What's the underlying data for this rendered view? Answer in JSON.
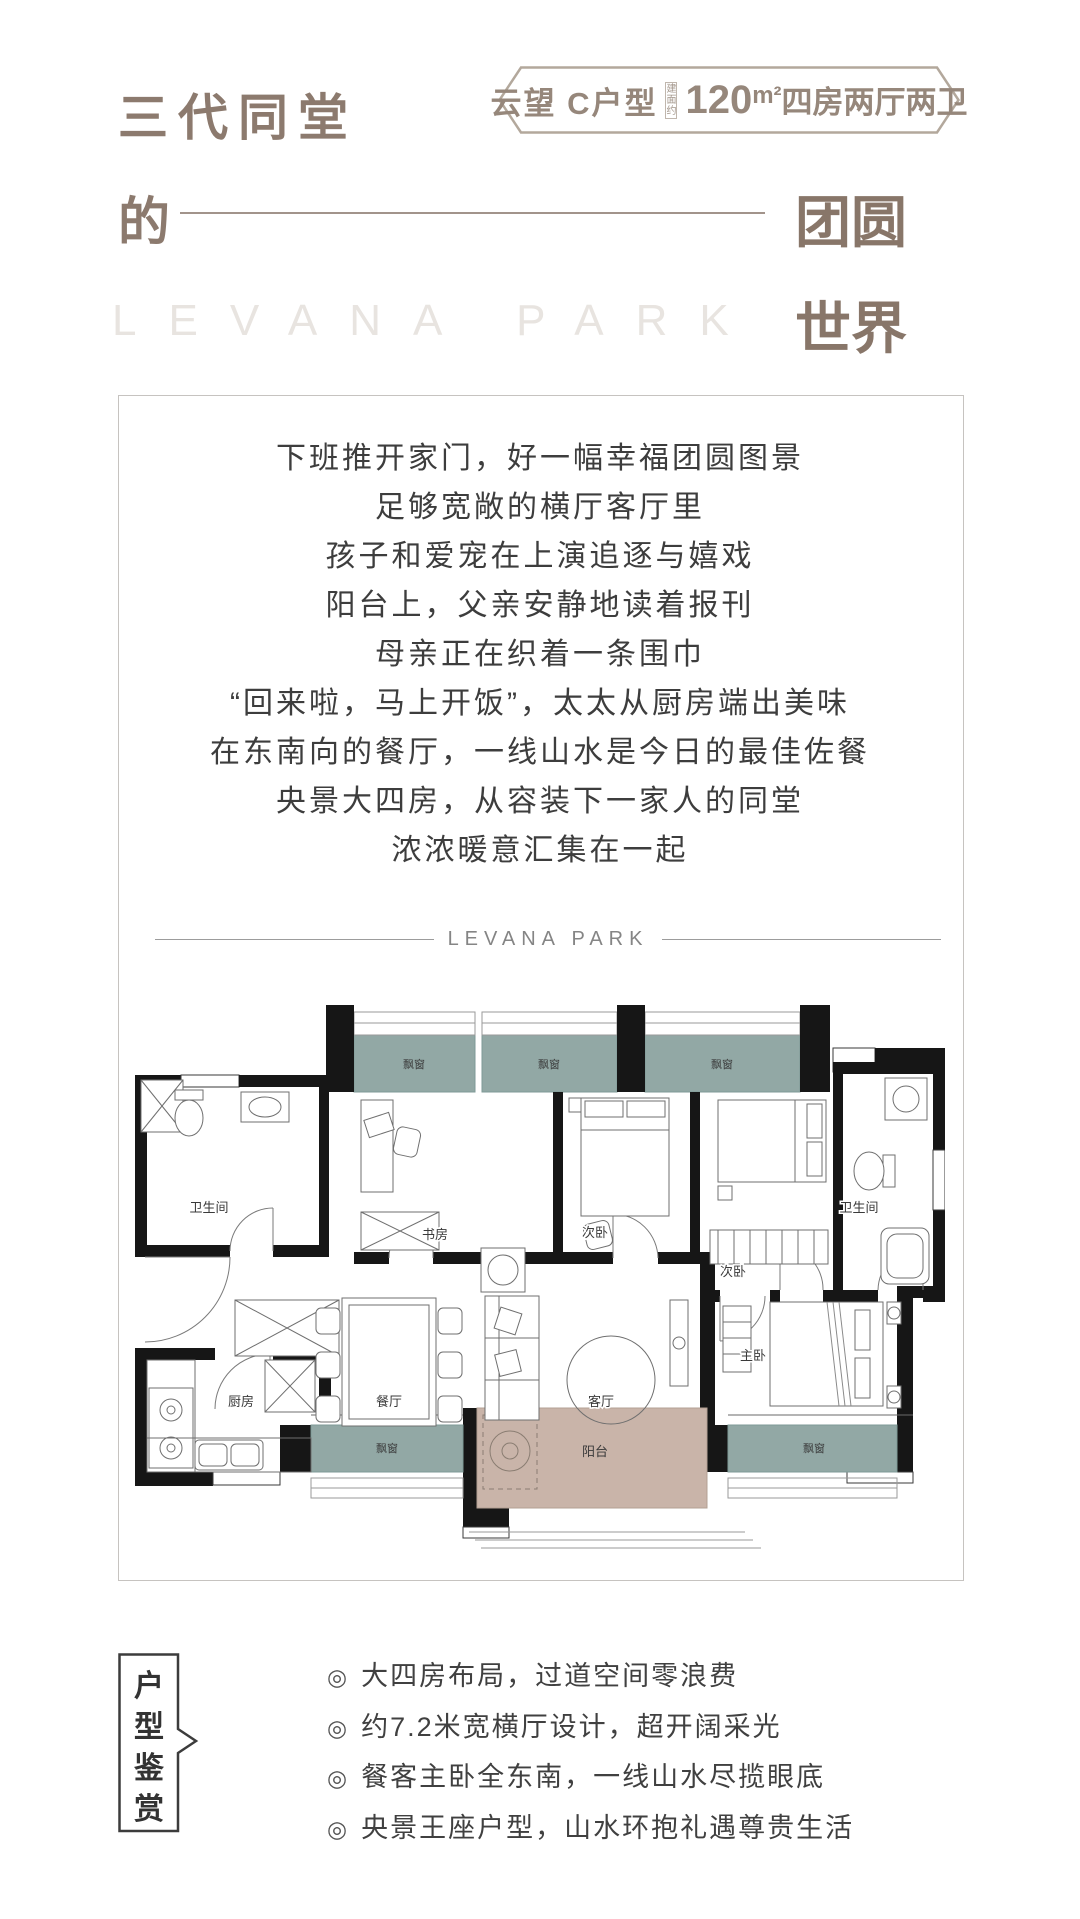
{
  "header": {
    "title_main": "三代同堂",
    "title_sub": "的",
    "title_right_top": "团圆",
    "title_right_bottom": "世界",
    "watermark": "LEVANA PARK",
    "accent_color": "#8c7a6e",
    "badge": {
      "name": "云望 C户型",
      "area_prefix": "建面约",
      "area_number": "120",
      "area_unit": "m²",
      "area_rooms": "四房两厅两卫",
      "border_color": "#b3a89c"
    }
  },
  "poem": {
    "lines": [
      "下班推开家门，好一幅幸福团圆图景",
      "足够宽敞的横厅客厅里",
      "孩子和爱宠在上演追逐与嬉戏",
      "阳台上，父亲安静地读着报刊",
      "母亲正在织着一条围巾",
      "“回来啦，马上开饭”，太太从厨房端出美味",
      "在东南向的餐厅，一线山水是今日的最佳佐餐",
      "央景大四房，从容装下一家人的同堂",
      "浓浓暖意汇集在一起"
    ]
  },
  "divider": {
    "brand": "LEVANA PARK"
  },
  "floorplan": {
    "labels": {
      "bay_window": "飘窗",
      "study": "书房",
      "bedroom": "次卧",
      "bathroom": "卫生间",
      "kitchen": "厨房",
      "dining": "餐厅",
      "living": "客厅",
      "master": "主卧",
      "balcony": "阳台"
    },
    "colors": {
      "bay_window": "#92a8a5",
      "balcony": "#c9b4a9",
      "wall": "#161616"
    }
  },
  "highlights": {
    "tag": "户型鉴赏",
    "bullet": "◎",
    "items": [
      "大四房布局，过道空间零浪费",
      "约7.2米宽横厅设计，超开阔采光",
      "餐客主卧全东南，一线山水尽揽眼底",
      "央景王座户型，山水环抱礼遇尊贵生活"
    ]
  }
}
